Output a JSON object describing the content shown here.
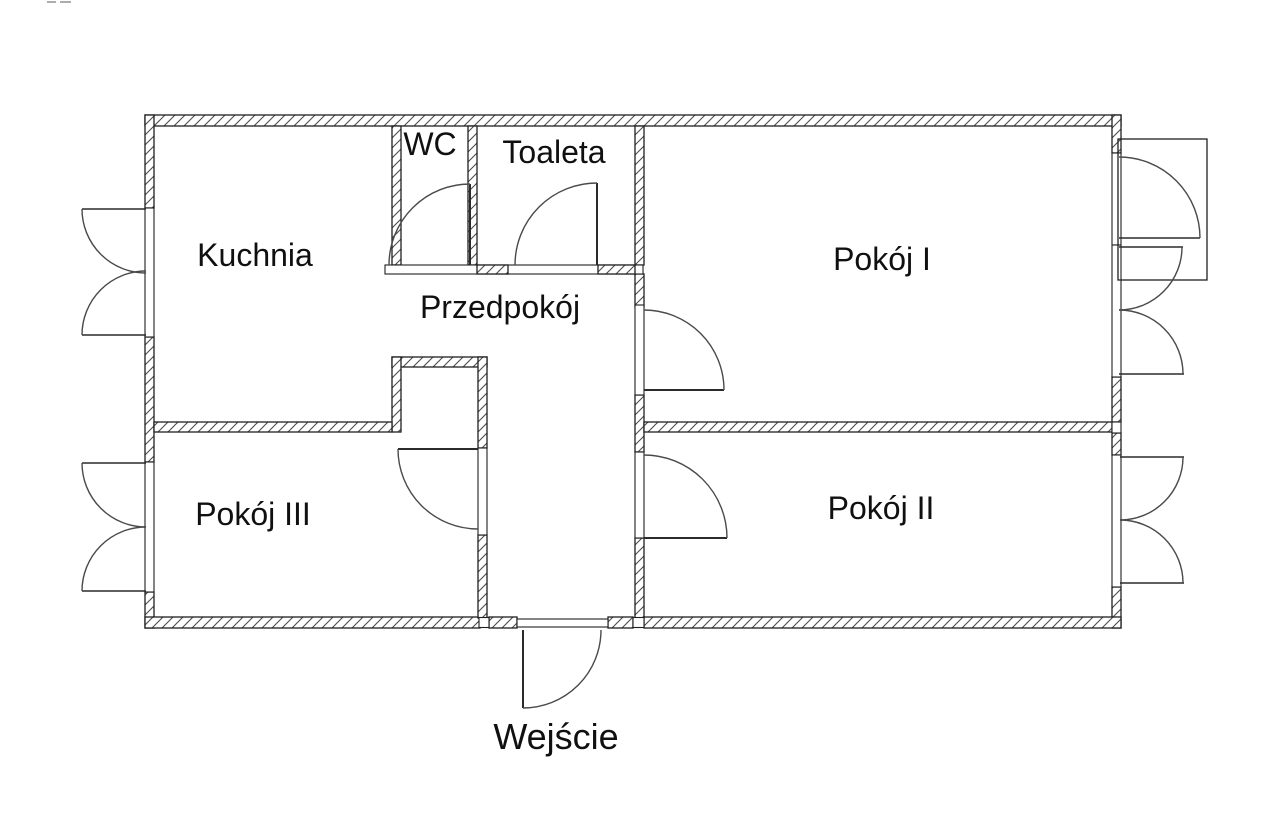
{
  "labels": {
    "kuchnia": "Kuchnia",
    "wc": "WC",
    "toaleta": "Toaleta",
    "przedpokoj": "Przedpokój",
    "pokoj1": "Pokój I",
    "pokoj2": "Pokój II",
    "pokoj3": "Pokój III",
    "wejscie": "Wejście"
  },
  "colors": {
    "background": "#ffffff",
    "wall_line": "#1f1f1f",
    "hatch_line": "#4d4d4d",
    "door_line": "#2b2b2b",
    "swing_line": "#4a4a4a",
    "text": "#101010"
  }
}
